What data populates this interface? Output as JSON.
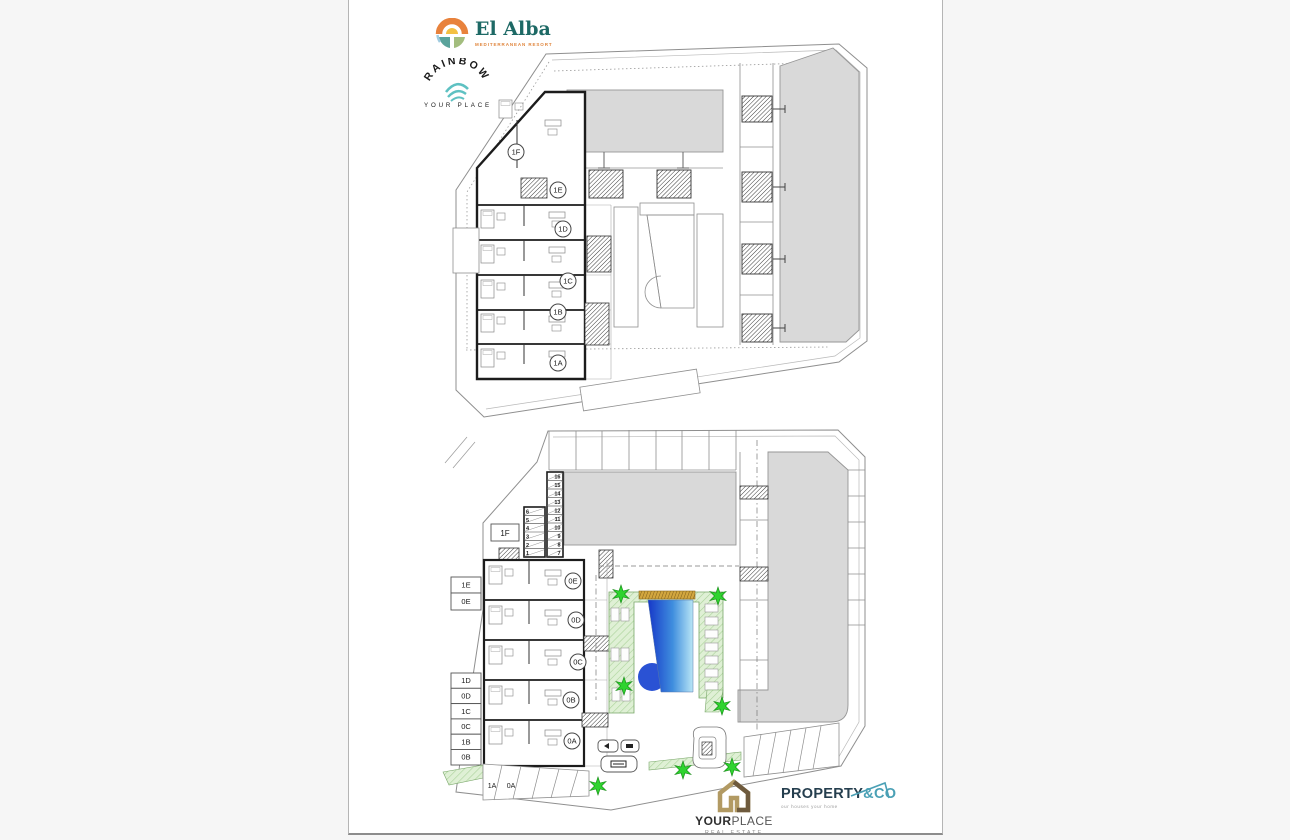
{
  "logos": {
    "el_alba": {
      "name": "El Alba",
      "tagline": "MEDITERRANEAN RESORT"
    },
    "rainbow": {
      "name": "RAINBOW",
      "subtitle": "YOUR PLACE"
    },
    "yourplace": {
      "name_bold": "YOUR",
      "name_light": "PLACE",
      "subtitle": "REAL ESTATE"
    },
    "property_co": {
      "name_dark": "PROPERTY",
      "name_accent": "&CO",
      "tagline": "our houses your home"
    }
  },
  "plans": {
    "first_floor": {
      "unit_labels": [
        "1F",
        "1E",
        "1D",
        "1C",
        "1B",
        "1A"
      ]
    },
    "ground_floor": {
      "circle_labels": [
        "0E",
        "0D",
        "0C",
        "0B",
        "0A"
      ],
      "side_boxes": [
        "1E",
        "0E",
        "1D",
        "0D",
        "1C",
        "0C",
        "1B",
        "0B"
      ],
      "terrace_label": "1F",
      "parking_labels": [
        "1A",
        "0A"
      ],
      "storage_left": [
        "6",
        "5",
        "4",
        "3",
        "2",
        "1"
      ],
      "storage_right": [
        "16",
        "15",
        "14",
        "13",
        "12",
        "11",
        "10",
        "9",
        "8",
        "7"
      ]
    },
    "colors": {
      "wall": "#1c1c1c",
      "building_fill": "#d9d9d9",
      "pool_dark": "#1638c8",
      "pool_light": "#b9e6f6",
      "lawn": "#dff0d5",
      "tree_star": "#2fd32f",
      "deck": "#d2a63e",
      "elalba_teal": "#1d6965",
      "elalba_orange": "#e0853c",
      "rainbow_gold": "#c49a55",
      "rainbow_teal": "#5ec1c2",
      "propco_dark": "#253e4e",
      "propco_teal": "#4aa0b5",
      "yourplace_gold": "#b29a63"
    }
  }
}
